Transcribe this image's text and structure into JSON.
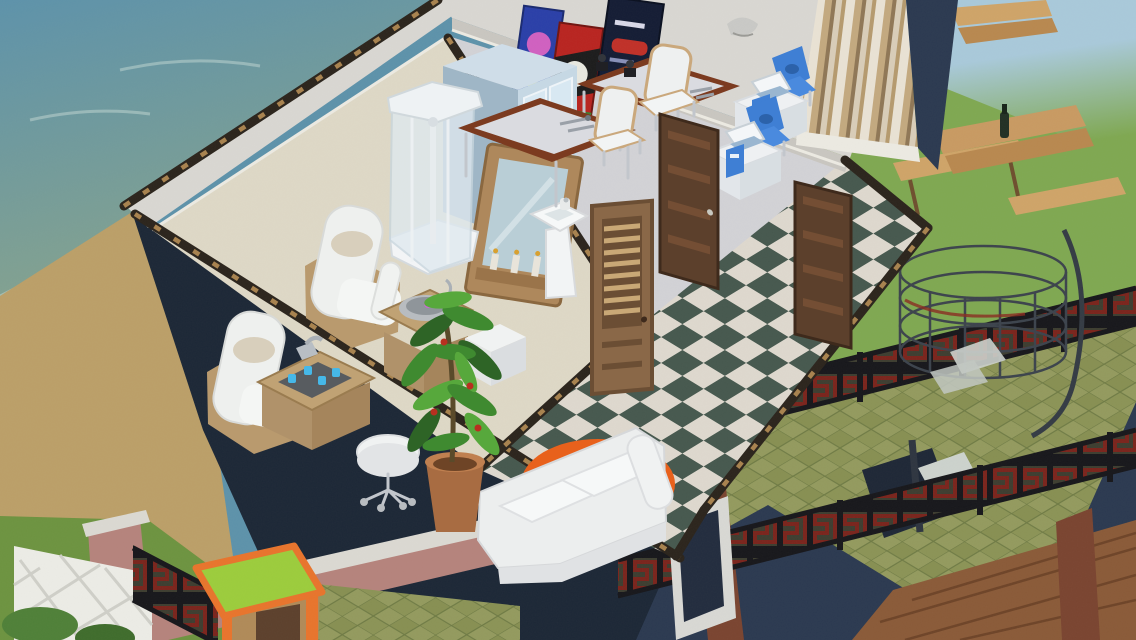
{
  "scene": {
    "type": "isometric life-simulation game view",
    "setting": "beachfront two-story house",
    "upper_floor_rooms": [
      "spa lounge with beige carpet",
      "office with lab desks and computer stations",
      "hallway with green-white checkered floor"
    ],
    "outdoors": [
      "ocean with surf",
      "sand beach",
      "lawn with picnic tables",
      "green tiled patio with caged spiral staircase",
      "greek-key railings",
      "brick seawall with white lattice fence"
    ]
  },
  "objects": [
    {
      "id": "shower-stall",
      "label": "glass shower enclosure"
    },
    {
      "id": "drinks-fridge",
      "label": "glass-door beverage cooler"
    },
    {
      "id": "wall-mirror",
      "label": "wood framed mirror with candle shelf"
    },
    {
      "id": "pedestal-sink",
      "label": "white pedestal sink"
    },
    {
      "id": "poster-blue",
      "label": "wall poster"
    },
    {
      "id": "poster-red",
      "label": "wall poster"
    },
    {
      "id": "poster-dark",
      "label": "wall poster"
    },
    {
      "id": "wall-sconce",
      "label": "wall lamp"
    },
    {
      "id": "lab-desk",
      "label": "wood and chrome desk with instruments"
    },
    {
      "id": "desk-chair",
      "label": "white curved chair"
    },
    {
      "id": "computer-station",
      "label": "white desk with laptop and blue chair"
    },
    {
      "id": "armchair",
      "label": "white spa armchair on wood base"
    },
    {
      "id": "side-table-basin",
      "label": "wood table with metal basin"
    },
    {
      "id": "side-table-drinks",
      "label": "wood table with glasses"
    },
    {
      "id": "ottoman",
      "label": "white ottoman cube"
    },
    {
      "id": "rolling-stool",
      "label": "white stool on casters"
    },
    {
      "id": "potted-plant",
      "label": "large potted plant"
    },
    {
      "id": "sofa",
      "label": "white loveseat"
    },
    {
      "id": "round-rug",
      "label": "round orange shag rug"
    },
    {
      "id": "louver-door",
      "label": "light wood louvered door"
    },
    {
      "id": "panel-door",
      "label": "dark wood panel door"
    },
    {
      "id": "picnic-table",
      "label": "wood picnic table with benches"
    },
    {
      "id": "spiral-staircase",
      "label": "caged spiral staircase"
    },
    {
      "id": "game-table",
      "label": "green-top table with orange trim"
    },
    {
      "id": "window",
      "label": "window in navy wall"
    }
  ],
  "palette": {
    "water_deep": "#5d92aa",
    "water_shallow": "#86a38d",
    "foam": "#cfe0da",
    "sand": "#bb9f68",
    "grass_left": "#6d9340",
    "grass_right": "#7fa851",
    "sky": "#a9c9da",
    "patio_a": "#939a5e",
    "patio_b": "#878f52",
    "patio_grout": "#6e7a44",
    "navy": "#2b3950",
    "navy_dark": "#1c2736",
    "interior_wall": "#d9d7d2",
    "interior_wall_shade": "#c9c6c0",
    "carpet": "#ded8c6",
    "office_floor": "#d2d2d6",
    "checker_dark": "#46584e",
    "checker_light": "#ded8ce",
    "stripe_light": "#e9e2d4",
    "stripe_mid": "#c3a97f",
    "stripe_dark": "#8f7756",
    "door_dark": "#5c402c",
    "door_light": "#8a6848",
    "door_slat": "#c9a876",
    "desk_wood": "#7c3b20",
    "desk_top": "#dadbe0",
    "chair_white": "#eef0f0",
    "pc_blue": "#3f7fd4",
    "pc_blue_dark": "#2c62aa",
    "fridge_body": "#9fb6c6",
    "fridge_side": "#c6d8e4",
    "glass": "#d8e8f2",
    "mirror_wood": "#ae885c",
    "mirror_glass": "#b9ced6",
    "plant_green": "#3f8a30",
    "plant_dark": "#2e6426",
    "pot": "#a86c42",
    "rug": "#e8611c",
    "sofa": "#eceeee",
    "picnic_a": "#cfa468",
    "picnic_b": "#b8884f",
    "fence_red": "#7a241c",
    "fence_tan": "#6b6a4a",
    "brick": "#b5837c",
    "brick_cap": "#dbd9d2",
    "lattice": "#ecece6",
    "vine": "#4f8038",
    "game_top": "#9ccc3c",
    "game_trim": "#e8742c",
    "game_body": "#b08a58",
    "metal": "#3c434c",
    "metal_light": "#ccd2cd",
    "roof_hex": "#8a5a38",
    "sconce": "#c9c9c6",
    "white_fix": "#f2f4f5",
    "shower_glass": "#dfe9ef"
  }
}
